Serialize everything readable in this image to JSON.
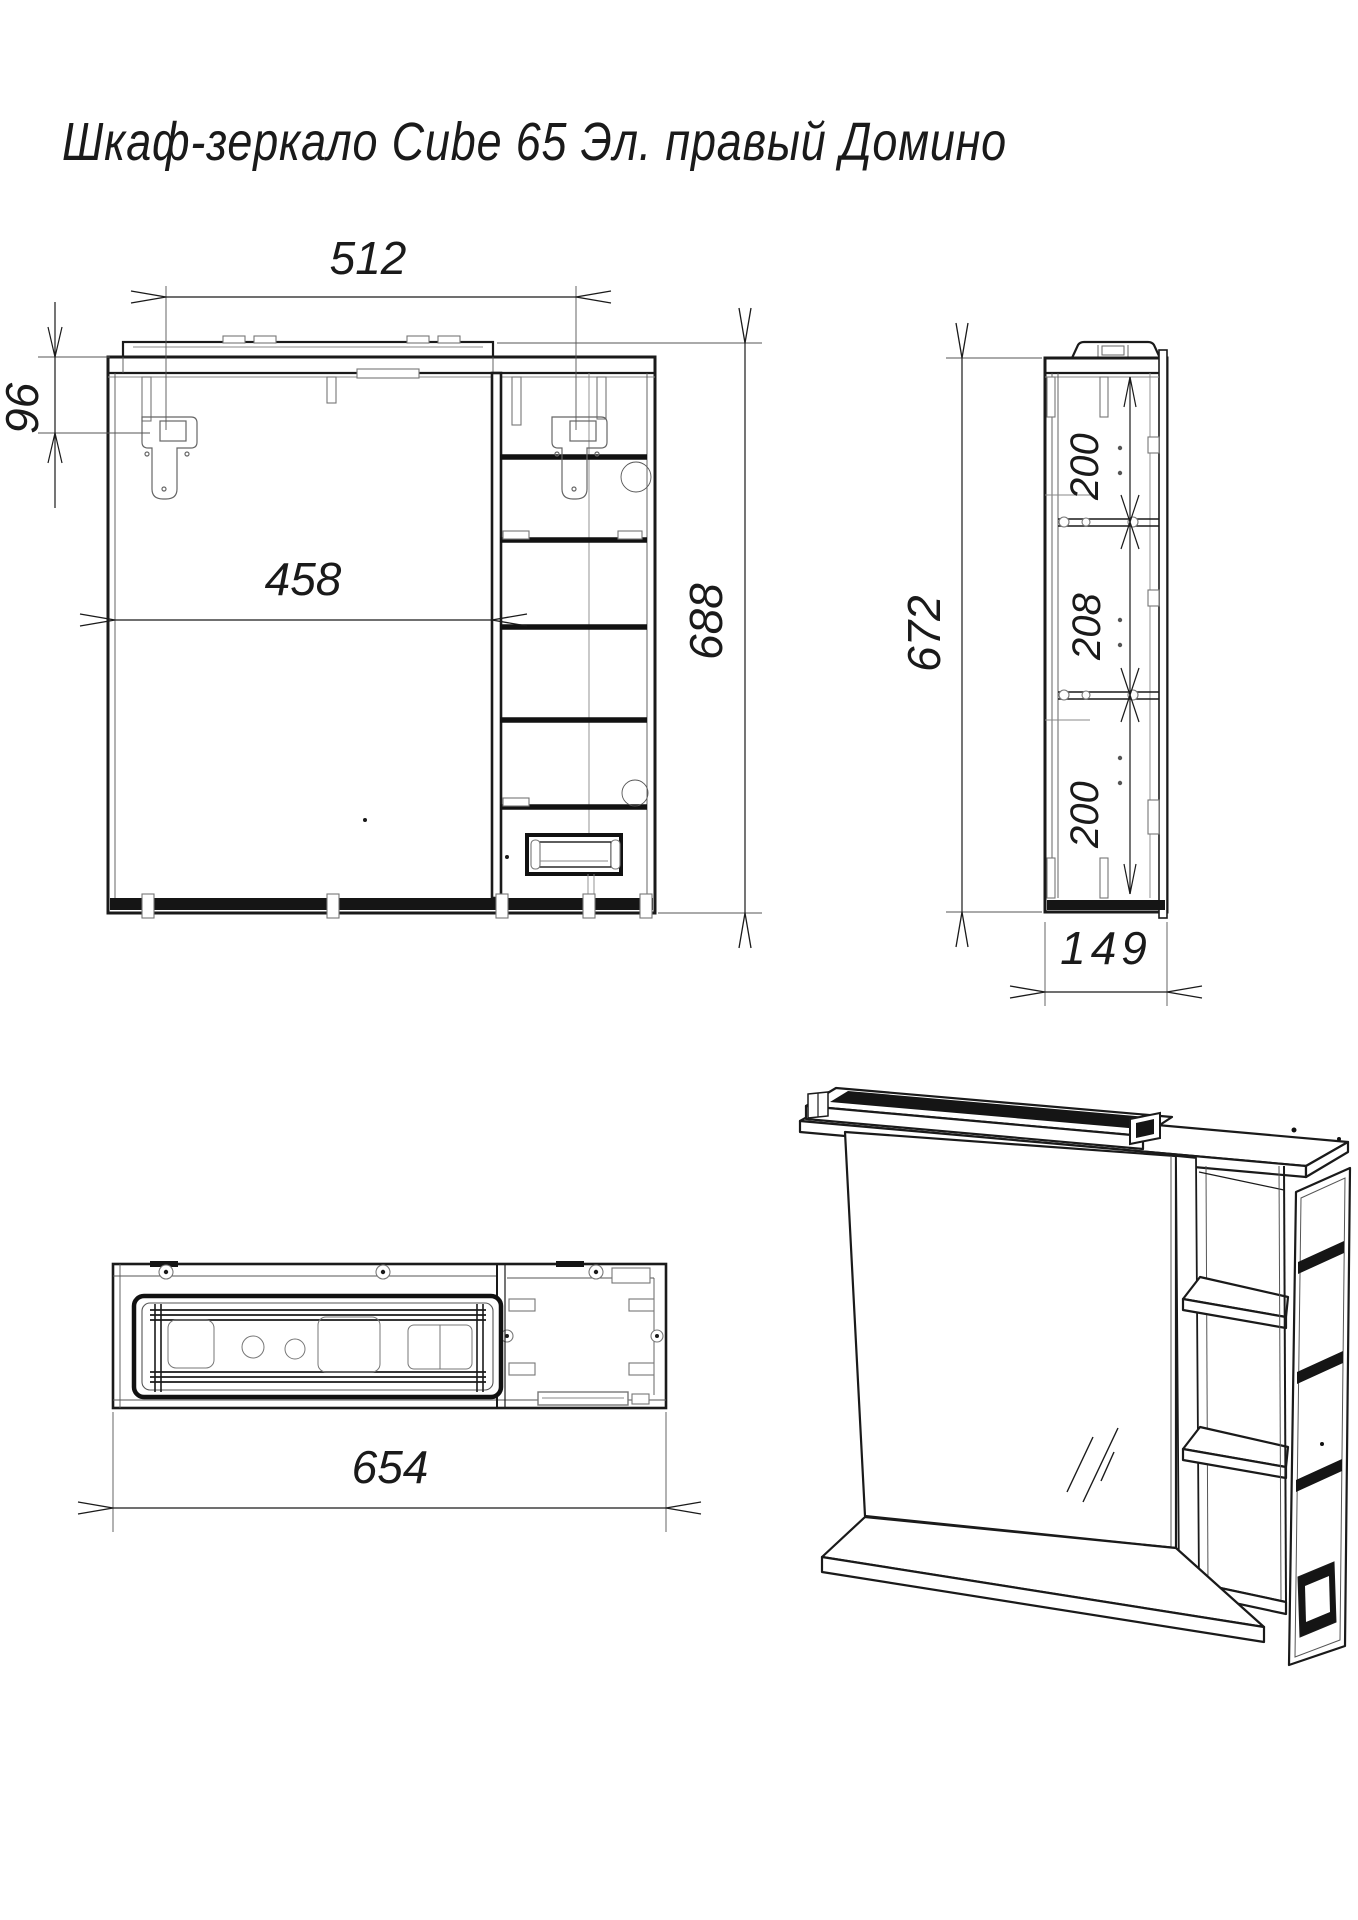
{
  "title": "Шкаф-зеркало Cube 65 Эл. правый Домино",
  "dimensions": {
    "front": {
      "mount_width": "512",
      "mount_offset": "96",
      "door_width": "458",
      "total_height": "688"
    },
    "side": {
      "total_height": "672",
      "section_top": "200",
      "section_middle": "208",
      "section_bottom": "200",
      "depth": "149"
    },
    "plan": {
      "total_width": "654"
    }
  },
  "colors": {
    "line": "#1a1a1a",
    "dark_fill": "#151515",
    "light_detail": "#777777",
    "background": "#ffffff"
  }
}
